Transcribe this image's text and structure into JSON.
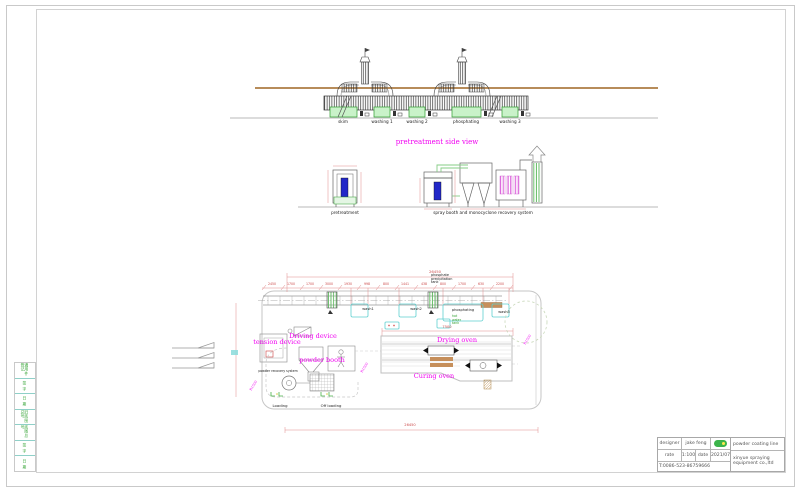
{
  "palette": {
    "accent_magenta": "#f000f0",
    "dim_red": "#cc4b4b",
    "tank_green": "#c9f2c9",
    "plan_cyan": "#5fcfcf",
    "wood_brown": "#c68f5b",
    "line_gray": "#c6c6c6",
    "blue_part": "#2228c8"
  },
  "side_view": {
    "title": "pretreatment side view",
    "tanks": [
      "skim",
      "washing 1",
      "washing 2",
      "phosphating",
      "washing 3"
    ]
  },
  "elevation": {
    "left_label": "pretreatment",
    "right_label": "spray booth and monocyclone recovery system"
  },
  "plan": {
    "dim_total": "26450",
    "dims": [
      "2450",
      "1700",
      "1700",
      "3000",
      "1930",
      "998",
      "800",
      "1441",
      "438",
      "800",
      "1700",
      "630",
      "2200"
    ],
    "oven_dim": "7500",
    "bottom_dim": "26450",
    "radius": [
      "R1500",
      "R1500",
      "R1500"
    ],
    "labels": {
      "phosphate_tank": "phosphate precipitation tank",
      "hot_water": "hot water tank",
      "tension": "tension device",
      "driving": "Driving device",
      "powder_booth": "powder booth",
      "recovery": "powder recovery system",
      "drying": "Drying oven",
      "curing": "Curing oven",
      "loading": "Loading",
      "offloading": "Off loading",
      "wash1": "wash1",
      "wash2": "wash2",
      "phosphating": "phosphating",
      "wash3": "wash3"
    }
  },
  "left_strip": {
    "cells": [
      "通用件登记",
      "签 字",
      "日 期",
      "旧底图总号",
      "底图总号",
      "签 字",
      "日 期"
    ]
  },
  "title_block": {
    "designer_label": "designer",
    "designer_value": "jake feng",
    "rate_label": "rate",
    "rate_value": "1:100",
    "date_label": "date",
    "date_value": "2021/07",
    "phone": "T:0086-523-86759666",
    "product": "powder coating line",
    "company": "xinyue spraying equipment co.,ltd"
  }
}
